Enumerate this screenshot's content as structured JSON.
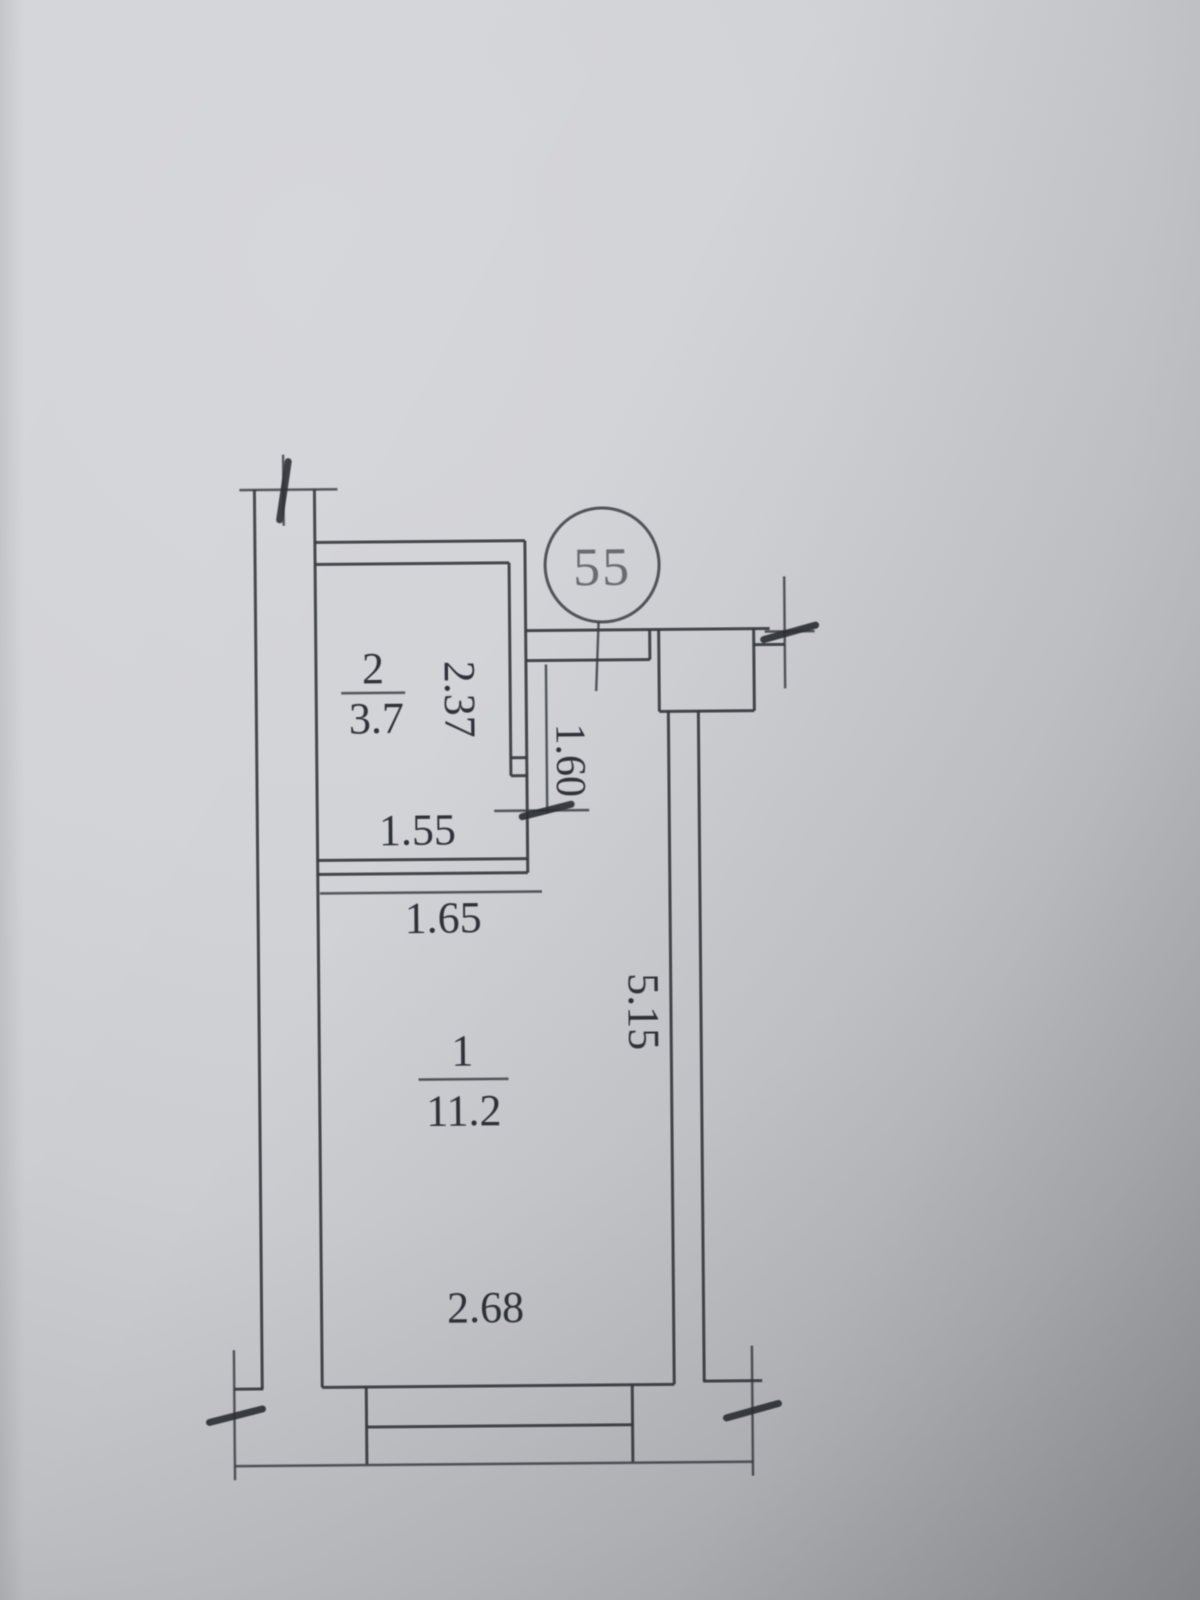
{
  "unit": {
    "badge": "55"
  },
  "rooms": {
    "room2": {
      "number": "2",
      "area": "3.7"
    },
    "room1": {
      "number": "1",
      "area": "11.2"
    }
  },
  "dims": {
    "room2_height": "2.37",
    "hall_depth": "1.60",
    "room2_width": "1.55",
    "room1_top_width": "1.65",
    "room1_height": "5.15",
    "room1_bottom_width": "2.68"
  },
  "colors": {
    "paper_light": "#d5d6da",
    "paper_dark": "#95979b",
    "ink": "#34373c"
  }
}
